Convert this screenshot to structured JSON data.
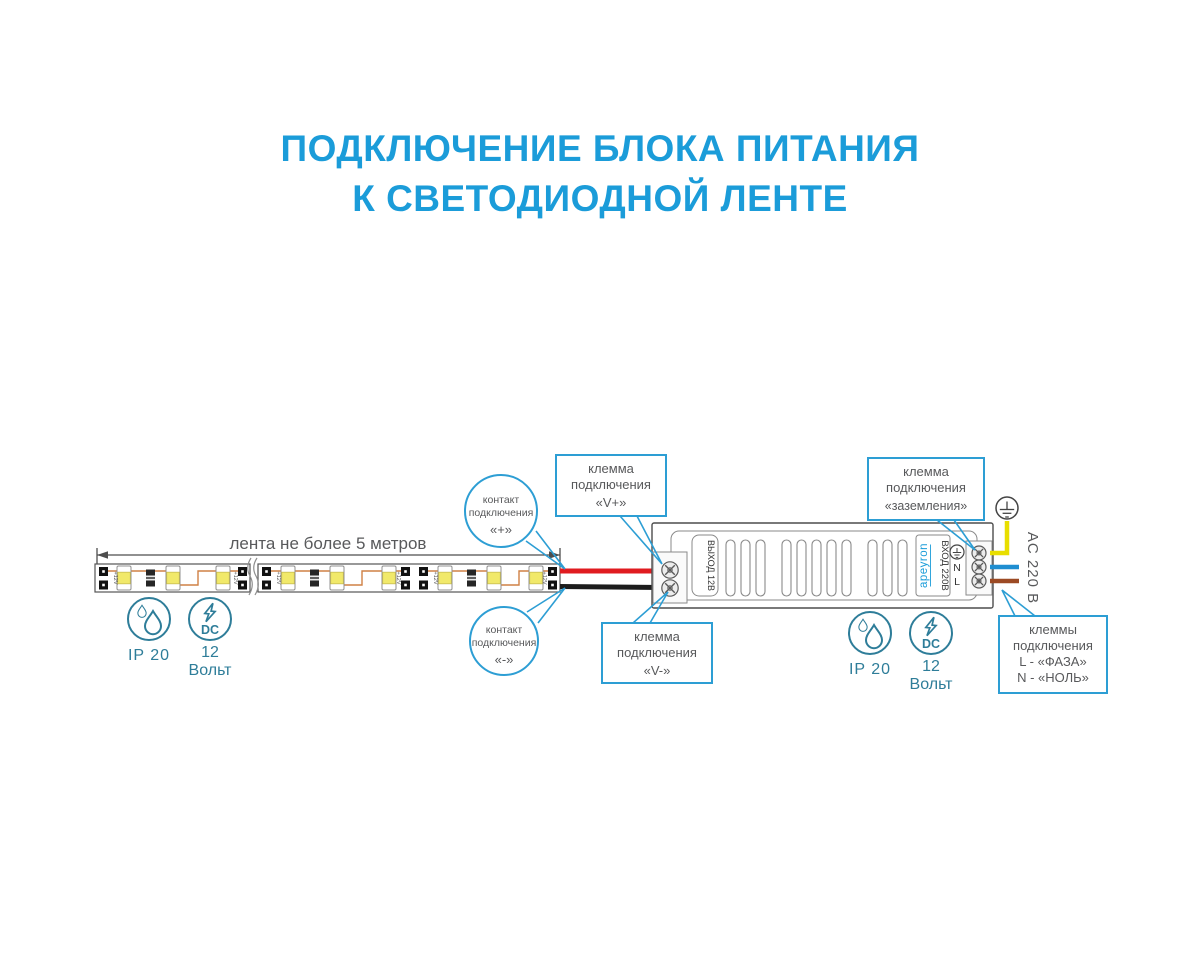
{
  "title": {
    "line1": "ПОДКЛЮЧЕНИЕ БЛОКА ПИТАНИЯ",
    "line2": "К СВЕТОДИОДНОЙ ЛЕНТЕ"
  },
  "strip": {
    "dimension_label": "лента не более 5 метров",
    "pad_marking": "+12V"
  },
  "specs": {
    "ip": "IP 20",
    "dc": "DC",
    "volt1": "12",
    "volt2": "Вольт"
  },
  "psu": {
    "brand": "apeyron",
    "output_label": "ВЫХОД 12В",
    "input_label": "ВХОД 220В",
    "vplus": "V+",
    "vminus": "V-",
    "neutral": "N",
    "line": "L",
    "ac_label": "AC 220 В"
  },
  "callouts": {
    "contact_plus": {
      "l1": "контакт",
      "l2": "подключения",
      "l3": "«+»"
    },
    "contact_minus": {
      "l1": "контакт",
      "l2": "подключения",
      "l3": "«-»"
    },
    "klemma_vplus": {
      "l1": "клемма",
      "l2": "подключения",
      "l3": "«V+»"
    },
    "klemma_vminus": {
      "l1": "клемма",
      "l2": "подключения",
      "l3": "«V-»"
    },
    "klemma_ground": {
      "l1": "клемма",
      "l2": "подключения",
      "l3": "«заземления»"
    },
    "klemma_ac": {
      "l1": "клеммы",
      "l2": "подключения",
      "l3": "L - «ФАЗА»",
      "l4": "N - «НОЛЬ»"
    }
  },
  "colors": {
    "accent_blue": "#1b9cd9",
    "callout_blue": "#2d9ed4",
    "text_gray": "#58595b",
    "icon_teal": "#2e7d99",
    "wire_red": "#e01b20",
    "wire_black": "#1c1c1c",
    "wire_yellow": "#e8de00",
    "wire_blue": "#1f8ed1",
    "wire_brown": "#9c4a24"
  }
}
